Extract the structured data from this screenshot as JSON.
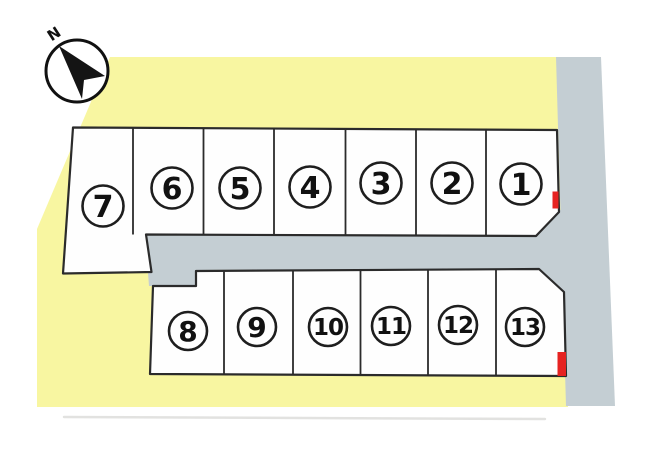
{
  "compass": {
    "label": "N"
  },
  "plots": [
    {
      "label": "1"
    },
    {
      "label": "2"
    },
    {
      "label": "3"
    },
    {
      "label": "4"
    },
    {
      "label": "5"
    },
    {
      "label": "6"
    },
    {
      "label": "7"
    },
    {
      "label": "8"
    },
    {
      "label": "9"
    },
    {
      "label": "10"
    },
    {
      "label": "11"
    },
    {
      "label": "12"
    },
    {
      "label": "13"
    }
  ],
  "red_markers_on_plots": [
    "1",
    "13"
  ],
  "colors": {
    "site_yellow": "#f8f6a1",
    "road_gray": "#c4ced3",
    "plot_fill": "#fefefe",
    "outline": "#2b2b2b",
    "marker_red": "#e62321"
  }
}
